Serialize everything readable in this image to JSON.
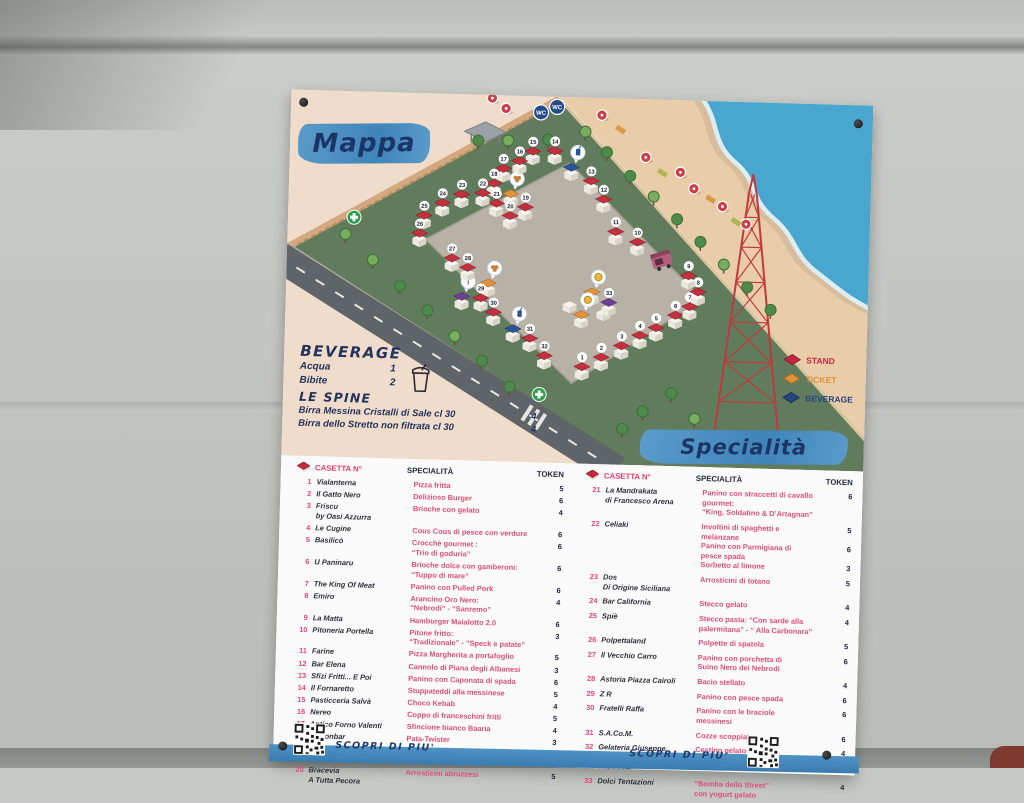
{
  "poster": {
    "banner": "Specialità",
    "map": {
      "title": "Mappa",
      "wc_label": "WC",
      "legend": [
        {
          "label": "STAND",
          "color": "#c2293f"
        },
        {
          "label": "TICKET",
          "color": "#e0913a"
        },
        {
          "label": "BEVERAGE",
          "color": "#27457e"
        }
      ],
      "stands": [
        {
          "n": "1",
          "x": 298,
          "y": 274
        },
        {
          "n": "2",
          "x": 317,
          "y": 264
        },
        {
          "n": "3",
          "x": 337,
          "y": 252
        },
        {
          "n": "4",
          "x": 355,
          "y": 241
        },
        {
          "n": "5",
          "x": 371,
          "y": 233
        },
        {
          "n": "6",
          "x": 390,
          "y": 220
        },
        {
          "n": "7",
          "x": 404,
          "y": 211
        },
        {
          "n": "8",
          "x": 412,
          "y": 196
        },
        {
          "n": "9",
          "x": 402,
          "y": 180
        },
        {
          "n": "10",
          "x": 350,
          "y": 148
        },
        {
          "n": "11",
          "x": 328,
          "y": 138
        },
        {
          "n": "12",
          "x": 315,
          "y": 106
        },
        {
          "n": "13",
          "x": 302,
          "y": 88
        },
        {
          "n": "14",
          "x": 265,
          "y": 59
        },
        {
          "n": "15",
          "x": 243,
          "y": 60
        },
        {
          "n": "16",
          "x": 230,
          "y": 70
        },
        {
          "n": "17",
          "x": 214,
          "y": 78
        },
        {
          "n": "18",
          "x": 205,
          "y": 93
        },
        {
          "n": "19",
          "x": 237,
          "y": 116
        },
        {
          "n": "20",
          "x": 222,
          "y": 125
        },
        {
          "n": "21",
          "x": 208,
          "y": 113
        },
        {
          "n": "22",
          "x": 194,
          "y": 103
        },
        {
          "n": "23",
          "x": 173,
          "y": 105
        },
        {
          "n": "24",
          "x": 154,
          "y": 114
        },
        {
          "n": "25",
          "x": 136,
          "y": 127
        },
        {
          "n": "26",
          "x": 132,
          "y": 145
        },
        {
          "n": "27",
          "x": 165,
          "y": 169
        },
        {
          "n": "28",
          "x": 181,
          "y": 178
        },
        {
          "n": "29",
          "x": 195,
          "y": 208
        },
        {
          "n": "30",
          "x": 208,
          "y": 222
        },
        {
          "n": "31",
          "x": 245,
          "y": 247
        },
        {
          "n": "32",
          "x": 260,
          "y": 264
        },
        {
          "n": "33",
          "x": 323,
          "y": 209,
          "t": "purple"
        }
      ],
      "extras": [
        {
          "x": 282,
          "y": 75,
          "t": "beverage",
          "bubble": "drink"
        },
        {
          "x": 228,
          "y": 238,
          "t": "beverage",
          "bubble": "drink"
        },
        {
          "x": 222,
          "y": 103,
          "t": "ticket",
          "bubble": "pretzel"
        },
        {
          "x": 202,
          "y": 193,
          "t": "ticket",
          "bubble": "pretzel"
        },
        {
          "x": 306,
          "y": 199,
          "t": "ticket",
          "bubble": "coin"
        },
        {
          "x": 296,
          "y": 222,
          "t": "ticket",
          "bubble": "coin"
        },
        {
          "x": 176,
          "y": 207,
          "t": "purple",
          "bubble": "info"
        },
        {
          "x": 318,
          "y": 214,
          "t": "plain"
        },
        {
          "x": 284,
          "y": 207,
          "t": "plain"
        }
      ],
      "umbrellas": [
        [
          201,
          3
        ],
        [
          215,
          13
        ],
        [
          311,
          17
        ],
        [
          356,
          58
        ],
        [
          391,
          72
        ],
        [
          405,
          88
        ],
        [
          434,
          105
        ],
        [
          458,
          122
        ]
      ],
      "towels": [
        [
          330,
          31
        ],
        [
          373,
          73
        ],
        [
          422,
          98
        ],
        [
          448,
          120
        ]
      ],
      "trees": [
        [
          295,
          34
        ],
        [
          317,
          54
        ],
        [
          341,
          77
        ],
        [
          365,
          97
        ],
        [
          389,
          119
        ],
        [
          413,
          141
        ],
        [
          437,
          163
        ],
        [
          461,
          185
        ],
        [
          485,
          207
        ],
        [
          86,
          168
        ],
        [
          114,
          193
        ],
        [
          142,
          217
        ],
        [
          170,
          242
        ],
        [
          198,
          266
        ],
        [
          226,
          291
        ],
        [
          58,
          143
        ],
        [
          360,
          312
        ],
        [
          388,
          293
        ],
        [
          412,
          318
        ],
        [
          340,
          330
        ],
        [
          188,
          46
        ],
        [
          218,
          45
        ],
        [
          258,
          43
        ]
      ],
      "aid": [
        [
          66,
          126
        ],
        [
          256,
          298
        ]
      ],
      "wc": [
        [
          250,
          16
        ],
        [
          266,
          10
        ]
      ]
    },
    "beverage": {
      "title": "BEVERAGE",
      "items": [
        {
          "name": "Acqua",
          "tokens": "1"
        },
        {
          "name": "Bibite",
          "tokens": "2"
        }
      ],
      "subtitle": "LE SPINE",
      "spine": [
        {
          "name": "Birra Messina Cristalli di Sale cl 30",
          "tokens": "4"
        },
        {
          "name": "Birra dello Stretto non filtrata cl 30",
          "tokens": "4"
        }
      ]
    },
    "table": {
      "casetta": "CASETTA N°",
      "specialita": "SPECIALITÀ",
      "token": "TOKEN"
    },
    "left_rows": [
      {
        "n": "1",
        "name": "Vialanterna",
        "items": [
          {
            "t": "Pizza fritta",
            "k": "5"
          }
        ]
      },
      {
        "n": "2",
        "name": "Il Gatto Nero",
        "items": [
          {
            "t": "Delizioso Burger",
            "k": "6"
          }
        ]
      },
      {
        "n": "3",
        "name": "Friscu\nby Oasi Azzurra",
        "items": [
          {
            "t": "Brioche con gelato",
            "k": "4"
          }
        ]
      },
      {
        "n": "4",
        "name": "Le Cugine",
        "items": [
          {
            "t": "Cous Cous di pesce con verdure",
            "k": "6"
          }
        ]
      },
      {
        "n": "5",
        "name": "Basilicò",
        "items": [
          {
            "t": "Crocchè gourmet :\n“Trio di goduria”",
            "k": "6"
          }
        ]
      },
      {
        "n": "6",
        "name": "U Paninaru",
        "items": [
          {
            "t": "Brioche dolce con gamberoni:\n“Tuppo di mare”",
            "k": "6"
          }
        ]
      },
      {
        "n": "7",
        "name": "The King Of Meat",
        "items": [
          {
            "t": "Panino con Pulled Pork",
            "k": "6"
          }
        ]
      },
      {
        "n": "8",
        "name": "Emiro",
        "items": [
          {
            "t": "Arancino Oro Nero:\n“Nebrodi” - “Sanremo”",
            "k": "4"
          }
        ]
      },
      {
        "n": "9",
        "name": "La Matta",
        "items": [
          {
            "t": "Hamburger Maialotto 2.0",
            "k": "6"
          }
        ]
      },
      {
        "n": "10",
        "name": "Pitoneria Portella",
        "items": [
          {
            "t": "Pitone fritto:\n“Tradizionale” - “Speck e patate”",
            "k": "3"
          }
        ]
      },
      {
        "n": "11",
        "name": "Farine",
        "items": [
          {
            "t": "Pizza Margherita a portafoglio",
            "k": "5"
          }
        ]
      },
      {
        "n": "12",
        "name": "Bar Elena",
        "items": [
          {
            "t": "Cannolo di Piana degli Albanesi",
            "k": "3"
          }
        ]
      },
      {
        "n": "13",
        "name": "Sfizi Fritti... E Poi",
        "items": [
          {
            "t": "Panino con Caponata di spada",
            "k": "6"
          }
        ]
      },
      {
        "n": "14",
        "name": "Il Fornaretto",
        "items": [
          {
            "t": "Stuppateddi alla messinese",
            "k": "5"
          }
        ]
      },
      {
        "n": "15",
        "name": "Pasticceria Salvà",
        "items": [
          {
            "t": "Choco Kebab",
            "k": "4"
          }
        ]
      },
      {
        "n": "16",
        "name": "Nereo",
        "items": [
          {
            "t": "Coppo di franceschini fritti",
            "k": "5"
          }
        ]
      },
      {
        "n": "17",
        "name": "Antico Forno Valenti",
        "items": [
          {
            "t": "Sfincione bianco Baaria",
            "k": "4"
          }
        ]
      },
      {
        "n": "18",
        "name": "Lemonbar",
        "items": [
          {
            "t": "Pata-Twister",
            "k": "3"
          }
        ]
      },
      {
        "n": "19",
        "name": "Pan D'Oro",
        "items": [
          {
            "t": "Panino con Braciole\ndi pesce spada",
            "k": "6"
          }
        ]
      },
      {
        "n": "20",
        "name": "Bracevia\nA Tutta Pecora",
        "items": [
          {
            "t": "Arrosticini abruzzesi",
            "k": "5"
          }
        ]
      }
    ],
    "right_rows": [
      {
        "n": "21",
        "name": "La Mandrakata\ndi Francesco Arena",
        "items": [
          {
            "t": "Panino con straccetti di cavallo\ngourmet:\n“King, Soldatino & D’Artagnan”",
            "k": "6"
          }
        ]
      },
      {
        "n": "22",
        "name": "Celiaki",
        "items": [
          {
            "t": "Involtini di spaghetti e\nmelanzane",
            "k": "5"
          },
          {
            "t": "Panino con Parmigiana di\npesce spada",
            "k": "6"
          },
          {
            "t": "Sorbetto al limone",
            "k": "3"
          }
        ]
      },
      {
        "n": "23",
        "name": "Dos\nDi Origine Siciliana",
        "items": [
          {
            "t": "Arrosticini di totano",
            "k": "5"
          }
        ]
      },
      {
        "n": "24",
        "name": "Bar California",
        "items": [
          {
            "t": "Stecco gelato",
            "k": "4"
          }
        ]
      },
      {
        "n": "25",
        "name": "Spiè",
        "items": [
          {
            "t": "Stecco pasta: “Con sarde alla\npalermitana” - “ Alla Carbonara”",
            "k": "4"
          }
        ]
      },
      {
        "n": "26",
        "name": "Polpettaland",
        "items": [
          {
            "t": "Polpette di spatola",
            "k": "5"
          }
        ]
      },
      {
        "n": "27",
        "name": "Il Vecchio Carro",
        "items": [
          {
            "t": "Panino con porchetta di\nSuino Nero dei Nebrodi",
            "k": "6"
          }
        ]
      },
      {
        "n": "28",
        "name": "Astoria Piazza Cairoli",
        "items": [
          {
            "t": "Bacio stellato",
            "k": "4"
          }
        ]
      },
      {
        "n": "29",
        "name": "Z R",
        "items": [
          {
            "t": "Panino con pesce spada",
            "k": "6"
          }
        ]
      },
      {
        "n": "30",
        "name": "Fratelli Raffa",
        "items": [
          {
            "t": "Panino con le braciole\nmessinesi",
            "k": "6"
          }
        ]
      },
      {
        "n": "31",
        "name": "S.A.Co.M.",
        "items": [
          {
            "t": "Cozze scoppiate",
            "k": "6"
          }
        ]
      },
      {
        "n": "32",
        "name": "Gelateria Giuseppe\nArena & Pasticceria\nTrischitta",
        "items": [
          {
            "t": "Cestino gelato:\n“Trionfo d’Agrumi”",
            "k": "4"
          }
        ]
      },
      {
        "n": "33",
        "name": "Dolci Tentazioni",
        "items": [
          {
            "t": "“Bomba dello Street”\ncon yogurt gelato",
            "k": "4"
          }
        ]
      }
    ],
    "footer": {
      "label": "SCOPRI DI PIU'"
    }
  }
}
